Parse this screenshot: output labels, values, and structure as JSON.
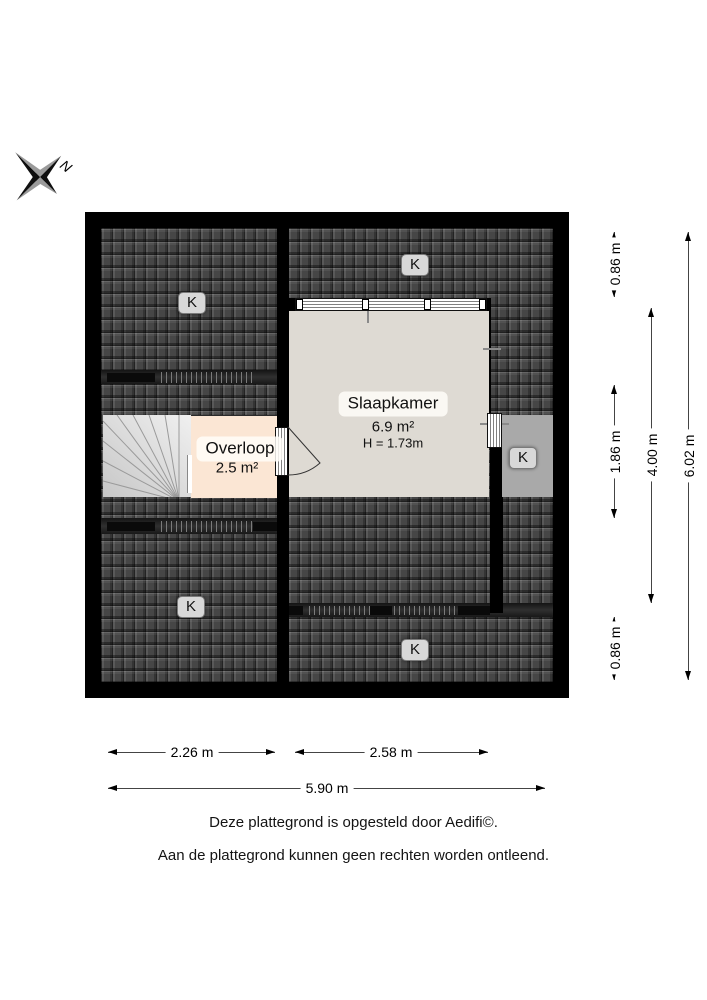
{
  "compass": {
    "north_label": "N"
  },
  "plan": {
    "rooms": [
      {
        "name": "Slaapkamer",
        "area": "6.9 m²",
        "ceiling_height": "H = 1.73m"
      },
      {
        "name": "Overloop",
        "area": "2.5 m²"
      }
    ],
    "roof_labels": [
      "K",
      "K",
      "K",
      "K",
      "K"
    ]
  },
  "dimensions": {
    "right": [
      {
        "label": "0.86 m"
      },
      {
        "label": "1.86 m"
      },
      {
        "label": "0.86 m"
      },
      {
        "label": "4.00 m"
      },
      {
        "label": "6.02 m"
      }
    ],
    "bottom": [
      {
        "label": "2.26 m"
      },
      {
        "label": "2.58 m"
      },
      {
        "label": "5.90 m"
      }
    ]
  },
  "footer": {
    "line1": "Deze plattegrond is opgesteld door Aedifi©.",
    "line2": "Aan de plattegrond kunnen geen rechten worden ontleend."
  },
  "colors": {
    "roof": "#464646",
    "wall": "#000000",
    "bedroom_floor": "#dedad3",
    "landing_floor": "#fbe6d4",
    "dormer": "#a9a9a9"
  }
}
